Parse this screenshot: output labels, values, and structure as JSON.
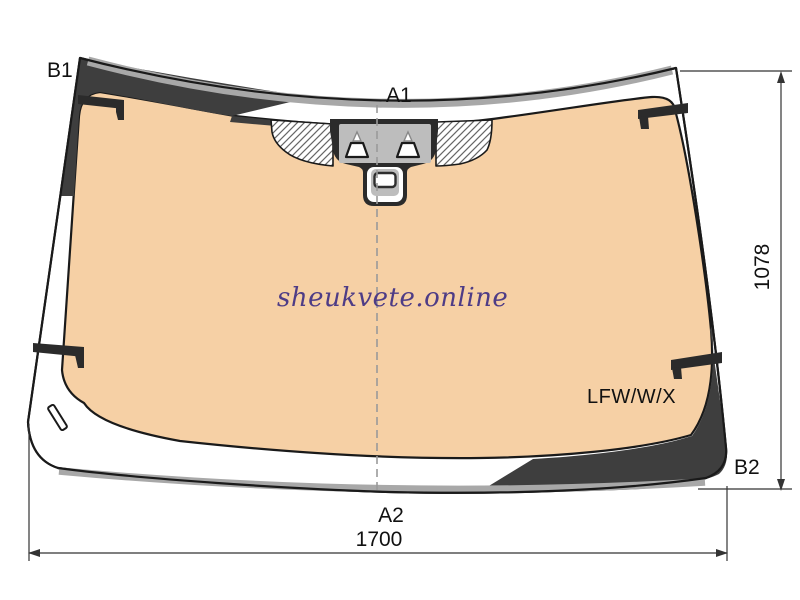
{
  "diagram": {
    "title_hint": "windscreen technical drawing",
    "watermark_text": "sheukvete.online",
    "part_code": "LFW/W/X",
    "callouts": {
      "b1": "B1",
      "a1": "A1",
      "a2": "A2",
      "b2": "B2"
    },
    "dimensions": {
      "height": "1078",
      "width": "1700"
    },
    "colors": {
      "glass": "#f6d0a5",
      "shade": "#3e3e3e",
      "shade_dark": "#2b2b2b",
      "trim_gray": "#a8a8a8",
      "sensor_gray": "#bdbdbd",
      "outline": "#1a1a1a",
      "dim_line": "#333333",
      "hatch_line": "#666666",
      "centerline": "#9a9a9a",
      "watermark": "#4e3c86"
    }
  }
}
